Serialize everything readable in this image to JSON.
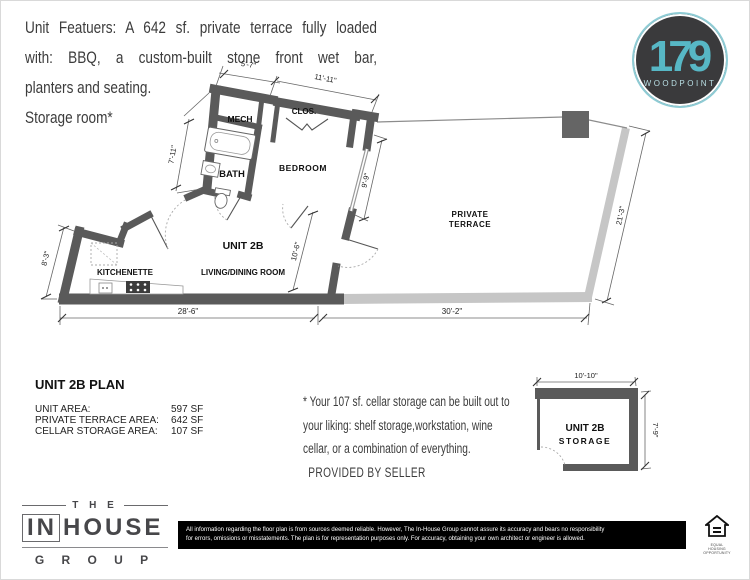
{
  "features": {
    "line1": "Unit Featuers: A 642 sf. private terrace fully loaded",
    "line2": "with: BBQ, a custom-built stone front wet bar,",
    "line3": "planters and seating.",
    "line4": "Storage room*"
  },
  "logo": {
    "number": "179",
    "name": "WOODPOINT",
    "teal": "#57b7c5",
    "dark": "#3a3a3c"
  },
  "plan": {
    "rooms": {
      "mech": "MECH",
      "closet": "CLOS.",
      "bath": "BATH",
      "bedroom": "BEDROOM",
      "unit": "UNIT 2B",
      "living": "LIVING/DINING ROOM",
      "kitchenette": "KITCHENETTE",
      "terrace_line1": "PRIVATE",
      "terrace_line2": "TERRACE"
    },
    "dims": {
      "d5_7": "5'-7\"",
      "d11_11": "11'-11\"",
      "d7_11": "7'-11\"",
      "d9_9": "9'-9\"",
      "d10_6": "10'-6\"",
      "d8_3": "8'-3\"",
      "d28_6": "28'-6\"",
      "d30_2": "30'-2\"",
      "d21_3": "21'-3\""
    },
    "wall_color": "#5a5a5a",
    "terrace_wall_color": "#c6c6c6"
  },
  "summary": {
    "title": "UNIT 2B PLAN",
    "rows": [
      {
        "label": "UNIT AREA:",
        "value": "597 SF"
      },
      {
        "label": "PRIVATE TERRACE AREA:",
        "value": "642 SF"
      },
      {
        "label": "CELLAR STORAGE AREA:",
        "value": "107 SF"
      }
    ]
  },
  "note": {
    "line1": "* Your 107 sf. cellar storage can be built out to",
    "line2": "your liking:  shelf storage,workstation, wine",
    "line3": "cellar, or a combination of everything.",
    "line4": "PROVIDED BY SELLER"
  },
  "storage_plan": {
    "name_line1": "UNIT 2B",
    "name_line2": "STORAGE",
    "width": "10'-10\"",
    "depth": "7'-9\""
  },
  "footer": {
    "brand": {
      "the": "T H E",
      "in": "IN",
      "house": "HOUSE",
      "group": "G R O U P"
    },
    "disclaimer_line1": "All information regarding the floor plan is from sources deemed reliable. However, The In-House Group cannot assure its accuracy and bears no responsibility",
    "disclaimer_line2": "for errors, omissions or misstatements.  The plan is for representation purposes only. For accuracy, obtaining your own architect or engineer is allowed.",
    "eho_caption": "EQUAL HOUSING OPPORTUNITY"
  }
}
